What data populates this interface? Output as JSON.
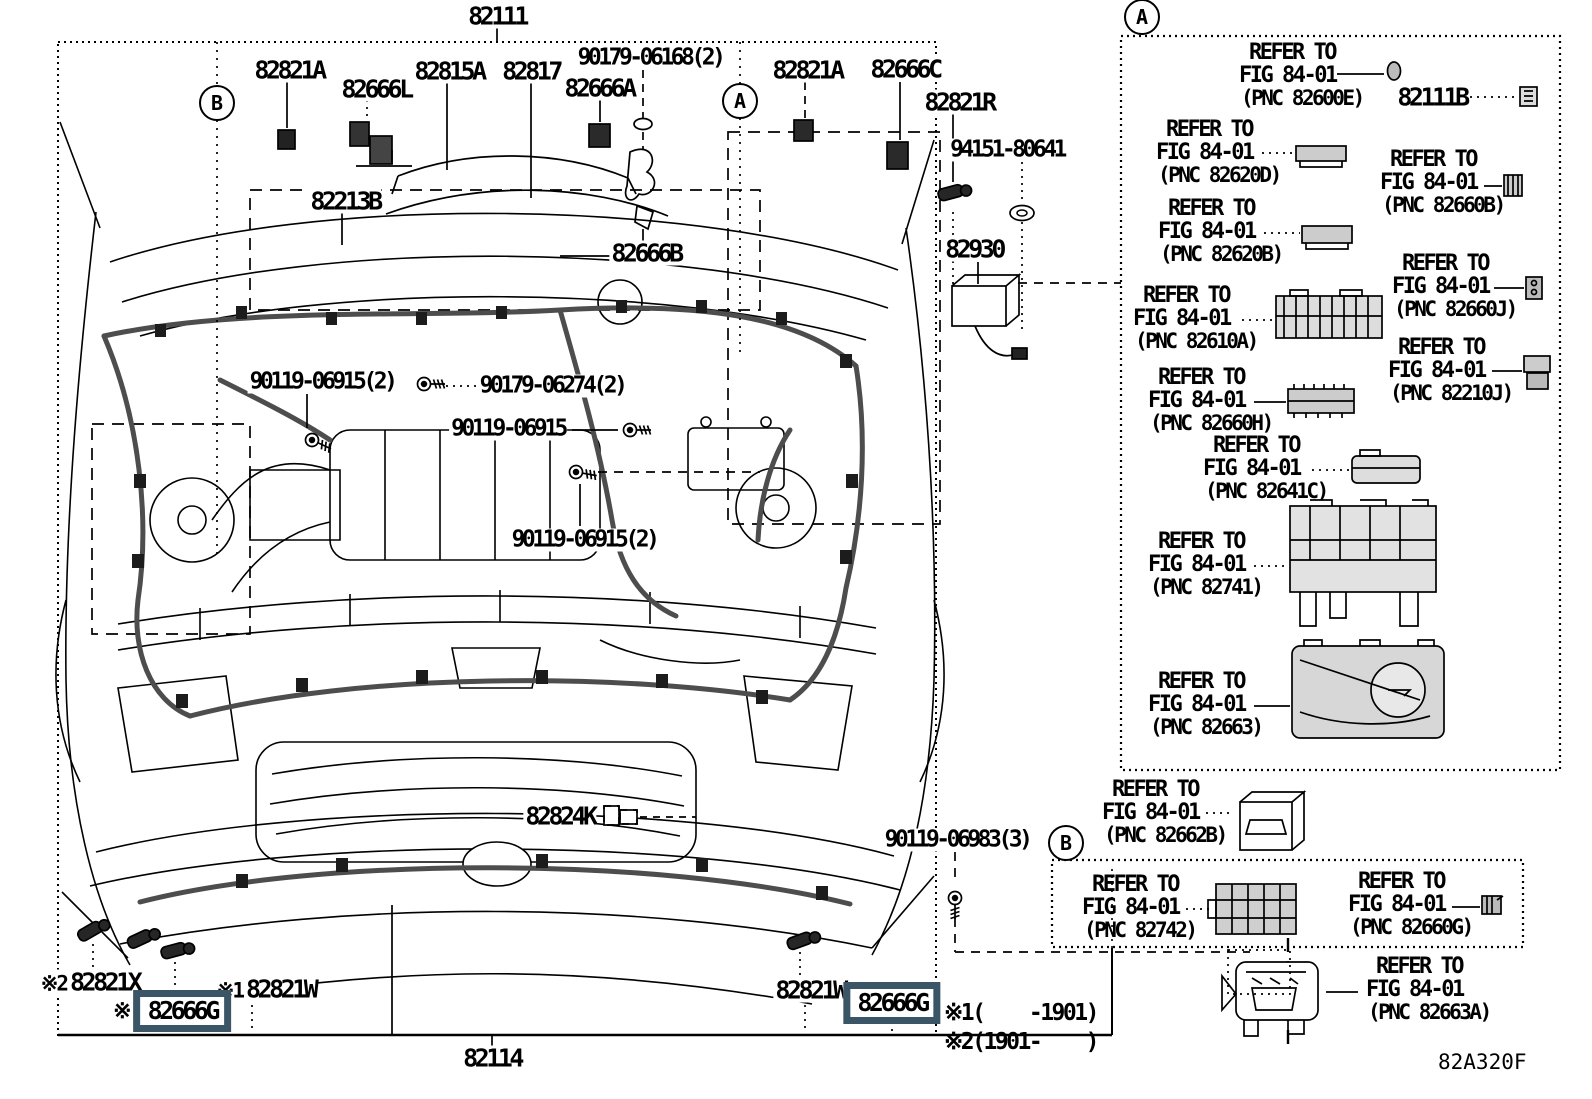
{
  "colors": {
    "highlight": "#3a5565",
    "ink": "#000000",
    "paper": "#ffffff"
  },
  "figure_code": "82A320F",
  "markers": {
    "a": "A",
    "b": "B"
  },
  "notes": {
    "n1": "※1(    -1901)",
    "n2": "※2(1901-    )"
  },
  "callouts": {
    "p82111": "82111",
    "p82821a_left": "82821A",
    "p82666l": "82666L",
    "p82815a": "82815A",
    "p82817": "82817",
    "p90179_06168": "90179-06168(2)",
    "p82666a": "82666A",
    "p82821a_right": "82821A",
    "p82666c": "82666C",
    "p82821r": "82821R",
    "p94151_80641": "94151-80641",
    "p82930": "82930",
    "p82213b": "82213B",
    "p82666b": "82666B",
    "p90119_06915_2_upper": "90119-06915(2)",
    "p90179_06274": "90179-06274(2)",
    "p90119_06915": "90119-06915",
    "p90119_06915_2_lower": "90119-06915(2)",
    "p82824k": "82824K",
    "p90119_06983": "90119-06983(3)",
    "p82821x_pre": "※2",
    "p82821x": "82821X",
    "p82821w_left_pre": "※1",
    "p82821w_left": "82821W",
    "p82666g_left_pre": "※",
    "p82666g_left": "82666G",
    "p82821w_right": "82821W",
    "p82666g_right": "82666G",
    "p82114": "82114",
    "p82111b": "82111B"
  },
  "refer_items": [
    {
      "l1": "REFER TO",
      "l2": "FIG 84-01",
      "l3": "(PNC 82600E)"
    },
    {
      "l1": "REFER TO",
      "l2": "FIG 84-01",
      "l3": "(PNC 82620D)"
    },
    {
      "l1": "REFER TO",
      "l2": "FIG 84-01",
      "l3": "(PNC 82660B)"
    },
    {
      "l1": "REFER TO",
      "l2": "FIG 84-01",
      "l3": "(PNC 82620B)"
    },
    {
      "l1": "REFER TO",
      "l2": "FIG 84-01",
      "l3": "(PNC 82660J)"
    },
    {
      "l1": "REFER TO",
      "l2": "FIG 84-01",
      "l3": "(PNC 82610A)"
    },
    {
      "l1": "REFER TO",
      "l2": "FIG 84-01",
      "l3": "(PNC 82210J)"
    },
    {
      "l1": "REFER TO",
      "l2": "FIG 84-01",
      "l3": "(PNC 82660H)"
    },
    {
      "l1": "REFER TO",
      "l2": "FIG 84-01",
      "l3": "(PNC 82641C)"
    },
    {
      "l1": "REFER TO",
      "l2": "FIG 84-01",
      "l3": "(PNC 82741)"
    },
    {
      "l1": "REFER TO",
      "l2": "FIG 84-01",
      "l3": "(PNC 82663)"
    },
    {
      "l1": "REFER TO",
      "l2": "FIG 84-01",
      "l3": "(PNC 82662B)"
    },
    {
      "l1": "REFER TO",
      "l2": "FIG 84-01",
      "l3": "(PNC 82742)"
    },
    {
      "l1": "REFER TO",
      "l2": "FIG 84-01",
      "l3": "(PNC 82660G)"
    },
    {
      "l1": "REFER TO",
      "l2": "FIG 84-01",
      "l3": "(PNC 82663A)"
    }
  ]
}
